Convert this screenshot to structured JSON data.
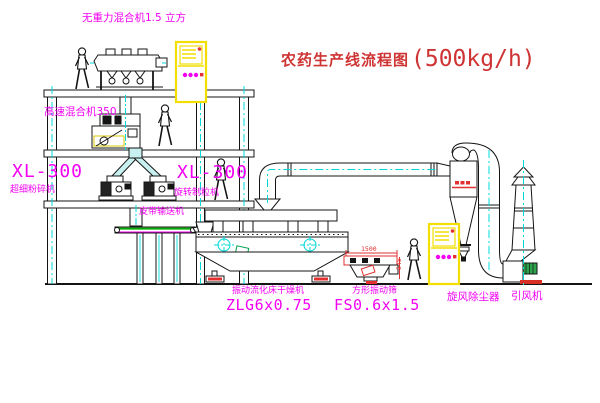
{
  "title": {
    "name": "农药生产线流程图",
    "capacity": "(500kg/h)"
  },
  "equipment": {
    "top_mixer": {
      "label": "无重力混合机1.5 立方"
    },
    "high_speed_mixer": {
      "label": "高速混合机350"
    },
    "pulverizer": {
      "model": "XL-300",
      "name": "超细粉碎机"
    },
    "granulator": {
      "model": "XL-300",
      "name": "旋转制粒机"
    },
    "belt_conveyor": {
      "name": "皮带输送机"
    },
    "fluid_bed_dryer": {
      "name": "振动流化床干燥机",
      "model": "ZLG6x0.75"
    },
    "vibrating_screen": {
      "name": "方形振动筛",
      "model": "FS0.6x1.5",
      "dim_width": "1500",
      "dim_height": "545"
    },
    "cyclone": {
      "name": "旋风除尘器"
    },
    "induced_draft_fan": {
      "name": "引风机"
    }
  },
  "colors": {
    "label_magenta": "#f200f2",
    "title_red": "#cf3434",
    "line_black": "#141414",
    "centerline_cyan": "#00d8d8",
    "cabinet_yellow": "#f2df00",
    "belt_green": "#00aa00",
    "accent_red": "#e33030",
    "motor_green": "#2fa24e"
  }
}
